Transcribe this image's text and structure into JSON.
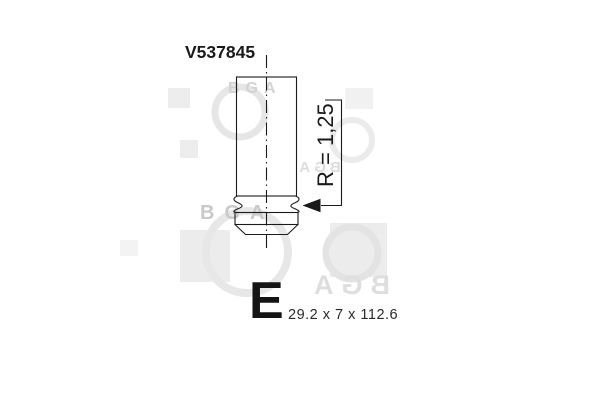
{
  "part": {
    "number": "V537845"
  },
  "drawing": {
    "radius_label": "R = 1,25",
    "type_letter": "E",
    "dimensions": "29.2 x 7 x 112.6"
  },
  "watermark": {
    "text": "BGA"
  },
  "colors": {
    "line": "#1a1a1a",
    "text": "#1a1a1a",
    "watermark_rect": "#ededed",
    "watermark_ring": "#e5e5e5",
    "watermark_letters": "#d5d5d5",
    "background": "#ffffff"
  }
}
